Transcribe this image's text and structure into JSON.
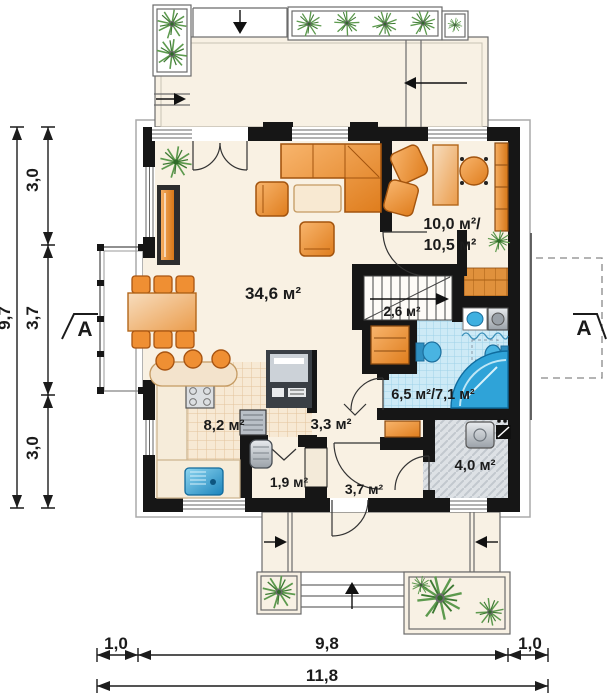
{
  "plan": {
    "type": "floor-plan",
    "rooms": {
      "living": {
        "area": "34,6 м²"
      },
      "office": {
        "area_line1": "10,0 м²/",
        "area_line2": "10,5 м²"
      },
      "stairs": {
        "area": "2,6 м²"
      },
      "bathroom": {
        "area": "6,5 м²/7,1 м²"
      },
      "kitchen": {
        "area": "8,2 м²"
      },
      "hall": {
        "area": "3,3 м²"
      },
      "pantry": {
        "area": "1,9 м²"
      },
      "vestibule": {
        "area": "3,7 м²"
      },
      "utility": {
        "area": "4,0 м²"
      }
    },
    "dimensions": {
      "v_total": "9,7",
      "v_segments": [
        "3,0",
        "3,7",
        "3,0"
      ],
      "h_segments": [
        "1,0",
        "9,8",
        "1,0"
      ],
      "h_total": "11,8"
    },
    "section_markers": {
      "left": "A",
      "right": "A"
    },
    "colors": {
      "wall": "#161616",
      "floor": "#f9f1e3",
      "furniture_orange": "#ec8a2c",
      "furniture_orange_dark": "#a9570f",
      "bath_tile": "#c9e9f6",
      "fixture_blue": "#2fa3d8",
      "utility_gray": "#dde1e5",
      "plant_green": "#5d9a4e",
      "dimension": "#1c1c1c"
    }
  }
}
